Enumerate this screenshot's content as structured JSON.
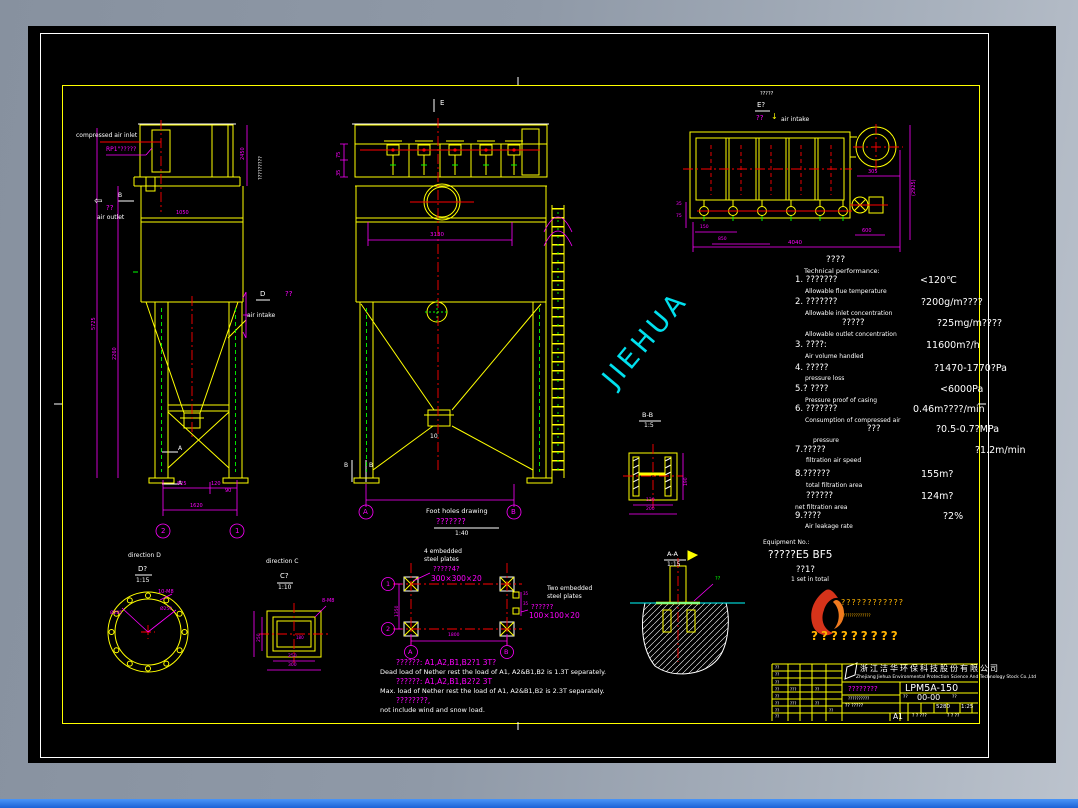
{
  "watermark": "JIEHUA",
  "left_view": {
    "compressed_air_inlet": "compressed air inlet",
    "rp1": "RP1\"?????",
    "b_mark": "B",
    "qq_out": "??",
    "arrow_out": "⇦",
    "air_outlet": "air outlet",
    "a_mark": "A",
    "vert_note": "?????????",
    "dim_2450": "2450",
    "dim_5725": "5725",
    "dim_2260": "2260",
    "dim_1050": "1050",
    "dim_825": "825",
    "dim_120": "120",
    "dim_90": "90",
    "dim_1620": "1620",
    "axis_2": "2",
    "axis_1": "1"
  },
  "mid_view": {
    "e_mark": "E",
    "d_mark": "D",
    "qq_in": "??",
    "air_intake": "air intake",
    "dim_75": "75",
    "dim_35": "35",
    "dim_3130": "3130",
    "ten": "10",
    "b_mark": "B",
    "axis_a": "A",
    "axis_b": "B"
  },
  "plan_view": {
    "dir_label": "?????",
    "e2": "E?",
    "qq": "??",
    "down_arrow": "↓",
    "air_intake": "air intake",
    "dim_305": "305",
    "dim_right": "(2925)",
    "dim_600": "600",
    "dim_35": "35",
    "dim_75": "75",
    "dim_150": "150",
    "dim_850": "850",
    "dim_total": "4040"
  },
  "tech": {
    "title_cn": "????",
    "title_en": "Technical performance:",
    "items": [
      {
        "cn": "1. ???????",
        "en": "Allowable flue temperature",
        "val": "<120℃"
      },
      {
        "cn": "2. ???????",
        "en": "Allowable inlet concentration",
        "val": "?200g/m????"
      },
      {
        "cn": "?????",
        "en": "Allowable outlet concentration",
        "val": "?25mg/m????"
      },
      {
        "cn": "3. ????:",
        "en": "Air volume handled",
        "val": "11600m?/h"
      },
      {
        "cn": "4. ?????",
        "en": "pressure loss",
        "val": "?1470-1770?Pa"
      },
      {
        "cn": "5.? ????",
        "en": "Pressure proof of casing",
        "val": "<6000Pa"
      },
      {
        "cn": "6. ???????",
        "en": "Consumption of compressed air",
        "val": "0.46m????/min"
      },
      {
        "cn": "???",
        "en": "pressure",
        "val": "?0.5-0.7?MPa"
      },
      {
        "cn": "7.?????",
        "en": "filtration air speed",
        "val": "?1.2m/min"
      },
      {
        "cn": "8.??????",
        "en": "total filtration area",
        "val": "155m?"
      },
      {
        "cn": "??????",
        "en": "net filtration area",
        "val": "124m?"
      },
      {
        "cn": "9.????",
        "en": "Air leakage rate",
        "val": "?2%"
      }
    ]
  },
  "equipment": {
    "label": "Equipment No.:",
    "no": "?????E5 BF5",
    "qty": "??1?",
    "qty_en": "1 set in total"
  },
  "logo": {
    "line1": "????????????",
    "caption": "?????????????",
    "line2": "?????????"
  },
  "foundation": {
    "title_en": "Foot holes drawing",
    "title_cn": "???????",
    "scale": "1:40",
    "p4_l1": "4 embedded",
    "p4_l2": "steel plates",
    "p4_cn": "?????4?",
    "p4_size": "300×300×20",
    "p2_l1": "Two embedded",
    "p2_l2": "steel plates",
    "p2_cn": "??????",
    "p2_size": "100×100×20",
    "ax1": "1",
    "ax2": "2",
    "axa": "A",
    "axb": "B",
    "d1350": "1350",
    "d1800": "1800",
    "d35a": "35",
    "d35b": "35"
  },
  "notes": {
    "n1": "??????: A1,A2,B1,B2?1 3T?",
    "n2": "Dead load of Nether rest the load of A1, A2&B1,B2 is 1.3T separately.",
    "n3": "??????: A1,A2,B1,B2?2 3T",
    "n4": "Max. load of Nether rest the load of A1, A2&B1,B2 is 2.3T separately.",
    "n5": "????????,",
    "n6": "not include wind and snow load."
  },
  "detail_d": {
    "dir": "direction D",
    "tag": "D?",
    "scale": "1:15",
    "bolts": "10-M8",
    "dia1": "Ø250",
    "dia2": "Ø285"
  },
  "detail_c": {
    "dir": "direction C",
    "tag": "C?",
    "scale": "1:10",
    "bolts": "8-M8",
    "d250": "250",
    "d300": "300",
    "d180": "180"
  },
  "section_bb": {
    "name": "B-B",
    "scale": "1:5",
    "d190": "190",
    "d120": "120",
    "d200": "200"
  },
  "section_aa": {
    "name": "A-A",
    "scale": "1:15",
    "note": "??"
  },
  "title_block": {
    "company_cn": "浙江洁华环保科技股份有限公司",
    "company_en": "Zhejiang Jiehua Environmental Protection Science And Technology Stock Co.,Ltd",
    "product_cn": "????????",
    "product_sub": "??????????",
    "model": "LPM5A-150",
    "dwg_label": "??",
    "dwg_no": "00-00",
    "rev": "??",
    "mat": "?? ?????",
    "weight": "5280",
    "scale": "1:25",
    "size": "A1",
    "sheets": "? ? ???",
    "sheet_no": "? ? ??",
    "ph": "??",
    "ph2": "???"
  }
}
